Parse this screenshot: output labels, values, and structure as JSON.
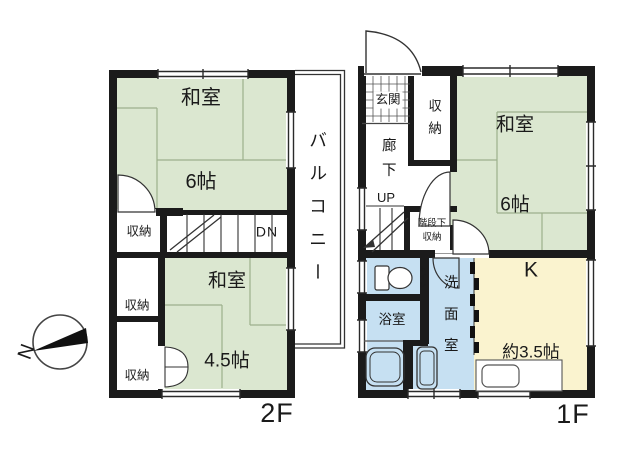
{
  "compass": {
    "north": "N"
  },
  "colors": {
    "tatami_green": "#dbe7d0",
    "wet_area_blue": "#c6e0f2",
    "kitchen_yellow": "#faf3cf",
    "wall_black": "#1b1b1b"
  },
  "floor2": {
    "label": "2F",
    "washitsu6": {
      "name": "和室",
      "size": "6帖"
    },
    "washitsu45": {
      "name": "和室",
      "size": "4.5帖"
    },
    "closet_mid": "収納",
    "closet_upper": "収納",
    "closet_lower": "収納",
    "stairs": "DN",
    "balcony": "バルコニー"
  },
  "floor1": {
    "label": "1F",
    "entrance": "玄関",
    "closet": "収納",
    "hallway": "廊下",
    "stairs": "UP",
    "under_stair_storage": {
      "line1": "階段下",
      "line2": "収納"
    },
    "washitsu6": {
      "name": "和室",
      "size": "6帖"
    },
    "kitchen": {
      "name": "K",
      "size": "約3.5帖"
    },
    "toilet": "トイレ",
    "bath": "浴室",
    "washroom": "洗面室"
  }
}
